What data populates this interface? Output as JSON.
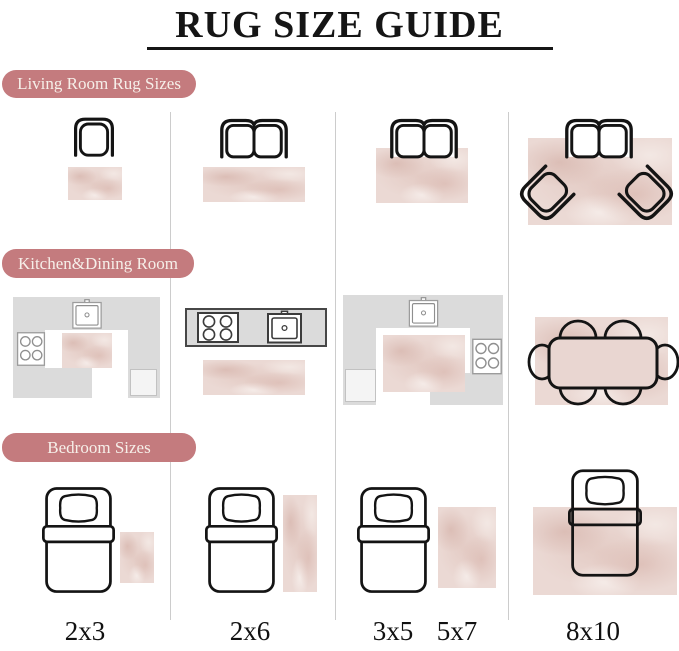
{
  "title": "RUG SIZE GUIDE",
  "sections": {
    "living": {
      "label": "Living Room Rug Sizes"
    },
    "kitchen": {
      "label": "Kitchen&Dining Room"
    },
    "bedroom": {
      "label": "Bedroom Sizes"
    }
  },
  "size_labels": {
    "col1": "2x3",
    "col2": "2x6",
    "col3a": "3x5",
    "col3b": "5x7",
    "col4": "8x10"
  },
  "colors": {
    "pill": "#c47b7e",
    "pill_text": "#f6efe9",
    "rug_base": "#ebd9d4",
    "counter_gray": "#dbdbdb",
    "counter_dark_border": "#474747",
    "outline_black": "#141414",
    "divider": "#cccccc"
  },
  "icons": {
    "armchair": "armchair-top-view-outline",
    "loveseat": "two-seat-sofa-top-view-outline",
    "accent_chair": "angled-armchair-outline",
    "bed": "single-bed-top-view-with-pillow",
    "dining_set": "dining-table-with-six-chairs",
    "sink": "kitchen-sink-top-view",
    "stove": "four-burner-stove-top-view"
  }
}
